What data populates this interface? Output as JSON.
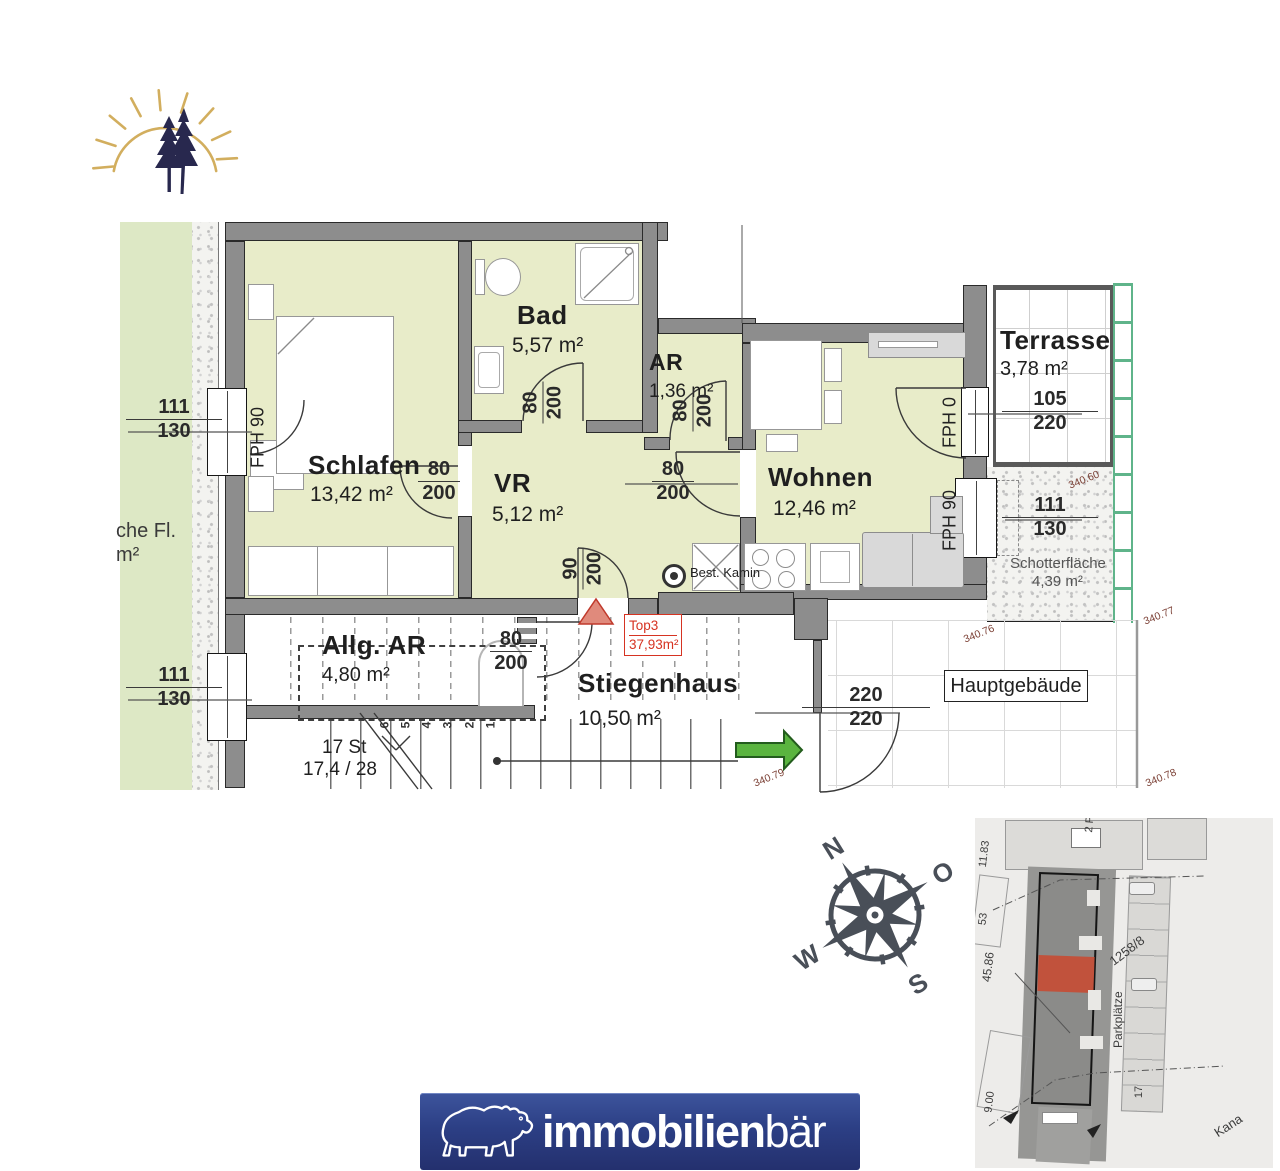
{
  "floorplan": {
    "rooms": {
      "schlafen": {
        "name": "Schlafen",
        "area": "13,42 m²"
      },
      "bad": {
        "name": "Bad",
        "area": "5,57 m²"
      },
      "ar": {
        "name": "AR",
        "area": "1,36 m²"
      },
      "vr": {
        "name": "VR",
        "area": "5,12 m²"
      },
      "wohnen": {
        "name": "Wohnen",
        "area": "12,46 m²"
      },
      "terrasse": {
        "name": "Terrasse",
        "area": "3,78 m²"
      },
      "allg_ar": {
        "name": "Allg. AR",
        "area": "4,80 m²"
      },
      "stiegenhaus": {
        "name": "Stiegenhaus",
        "area": "10,50 m²"
      },
      "schotterflaeche": {
        "name": "Schotterfläche",
        "area": "4,39 m²"
      }
    },
    "unit_badge": {
      "line1": "Top3",
      "line2": "37,93m²"
    },
    "labels": {
      "hauptgebaeude": "Hauptgebäude",
      "best_kamin": "Best. Kamin",
      "left_cut_line1": "che Fl.",
      "left_cut_line2": "m²",
      "stairs_count": "17 St",
      "stairs_ratio": "17,4 / 28"
    },
    "step_numbers": [
      "6",
      "5",
      "4",
      "3",
      "2",
      "1"
    ],
    "dims": {
      "window_left_top": {
        "num": "111",
        "den": "130"
      },
      "window_left_bottom": {
        "num": "111",
        "den": "130"
      },
      "door_schlafen": {
        "num": "80",
        "den": "200"
      },
      "door_bad": {
        "num": "80",
        "den": "200"
      },
      "door_ar": {
        "num": "80",
        "den": "200"
      },
      "door_wohnen": {
        "num": "80",
        "den": "200"
      },
      "door_entry": {
        "num": "90",
        "den": "200"
      },
      "door_allg_ar": {
        "num": "80",
        "den": "200"
      },
      "door_terrasse": {
        "num": "105",
        "den": "220"
      },
      "window_schotter": {
        "num": "111",
        "den": "130"
      },
      "door_haupt": {
        "num": "220",
        "den": "220"
      }
    },
    "fph": {
      "left": "FPH 90",
      "terrace_door": "FPH 0",
      "right_window": "FPH 90"
    },
    "elevations": {
      "e1": "340.60",
      "e2": "340.77",
      "e3": "340.76",
      "e4": "340.79",
      "e5": "340.78"
    }
  },
  "compass": {
    "n": "N",
    "e": "O",
    "s": "S",
    "w": "W"
  },
  "siteplan": {
    "labels": {
      "l1": "11.83",
      "l2": "53",
      "l3": "45.86",
      "l4": "9.00",
      "l5": "2 Park",
      "l6": "1258/8",
      "l7": "Parkplätze",
      "l8": "17",
      "l9": "Kana"
    }
  },
  "brand": {
    "bold": "immobilien",
    "light": "bär"
  },
  "colors": {
    "room_fill": "#e8ecc9",
    "wall_gray": "#8d8d8d",
    "garden_green": "#dde8c5",
    "accent_red": "#d63322",
    "arrow_green": "#5ab43f",
    "brand_blue": "#2c3f85",
    "fence_green": "#5fb48a",
    "siteplan_red": "#c1523c",
    "logo_gold": "#d2ae5e",
    "logo_navy": "#28284e"
  }
}
